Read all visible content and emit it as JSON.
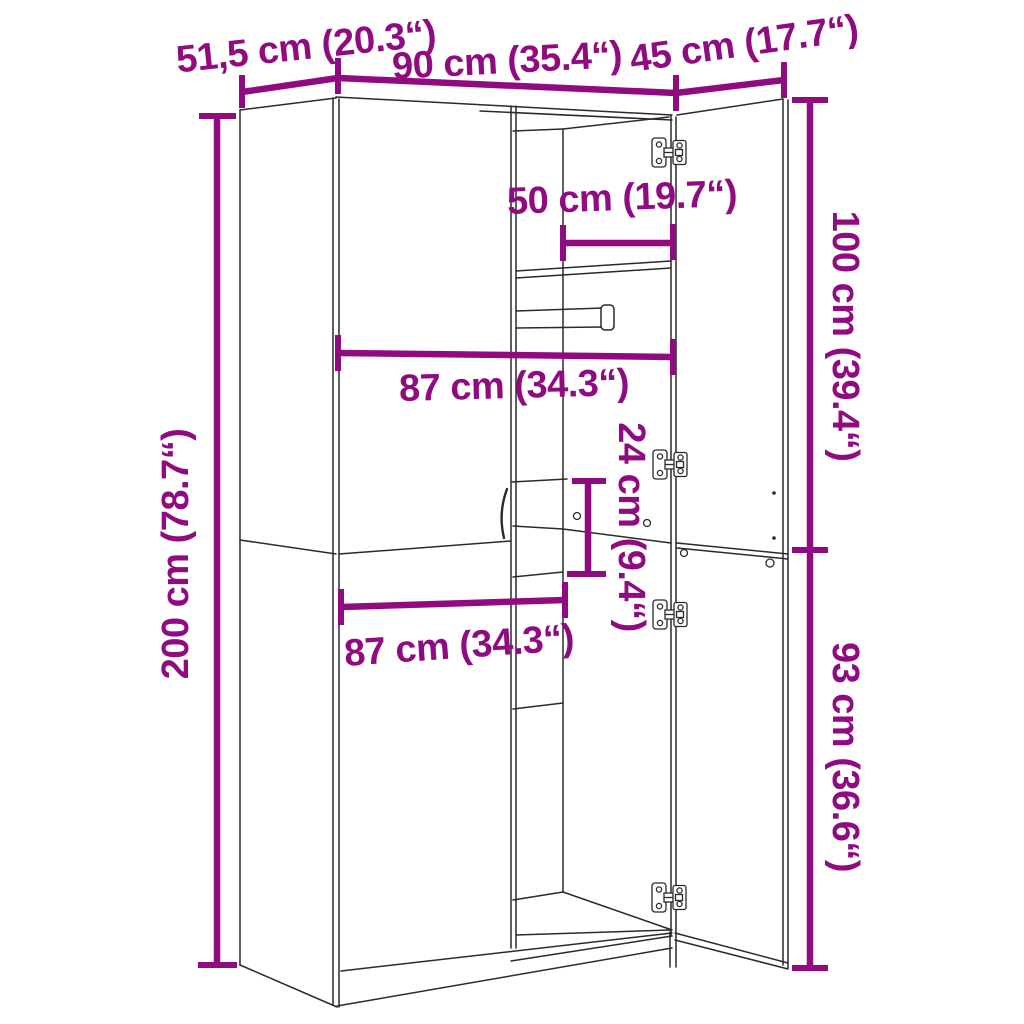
{
  "meta": {
    "title": "Wardrobe dimension diagram",
    "background": "#ffffff"
  },
  "colors": {
    "dimension": "#910b80",
    "line": "#2a2a2a",
    "fill": "#ffffff"
  },
  "dimensions": [
    {
      "id": "top-depth",
      "label": "51,5 cm (20.3“)",
      "value_cm": 51.5,
      "value_in": 20.3,
      "lines": [
        [
          242,
          92,
          338,
          78
        ]
      ],
      "ticks": [
        [
          242,
          75,
          242,
          108
        ],
        [
          338,
          58,
          338,
          94
        ]
      ],
      "label_pos": {
        "x": 306,
        "y": 47,
        "rot": -6
      }
    },
    {
      "id": "top-width",
      "label": "90 cm (35.4“)",
      "value_cm": 90,
      "value_in": 35.4,
      "lines": [
        [
          338,
          78,
          676,
          93
        ]
      ],
      "ticks": [
        [
          676,
          75,
          676,
          111
        ]
      ],
      "label_pos": {
        "x": 507,
        "y": 61,
        "rot": -3
      }
    },
    {
      "id": "door-width",
      "label": "45 cm (17.7“)",
      "value_cm": 45,
      "value_in": 17.7,
      "lines": [
        [
          676,
          93,
          784,
          80
        ]
      ],
      "ticks": [
        [
          784,
          62,
          784,
          98
        ]
      ],
      "label_pos": {
        "x": 744,
        "y": 44,
        "rot": -8
      }
    },
    {
      "id": "inner-depth",
      "label": "50 cm (19.7“)",
      "value_cm": 50,
      "value_in": 19.7,
      "lines": [
        [
          563,
          243,
          673,
          243
        ]
      ],
      "ticks": [
        [
          563,
          225,
          563,
          261
        ],
        [
          673,
          224,
          673,
          260
        ]
      ],
      "label_pos": {
        "x": 622,
        "y": 198,
        "rot": -2
      }
    },
    {
      "id": "upper-inner-width",
      "label": "87 cm (34.3“)",
      "value_cm": 87,
      "value_in": 34.3,
      "lines": [
        [
          338,
          353,
          673,
          357
        ]
      ],
      "ticks": [
        [
          338,
          335,
          338,
          371
        ],
        [
          673,
          339,
          673,
          375
        ]
      ],
      "label_pos": {
        "x": 514,
        "y": 386,
        "rot": -1.5
      }
    },
    {
      "id": "cubby-height",
      "label": "24 cm (9.4“)",
      "value_cm": 24,
      "value_in": 9.4,
      "lines": [
        [
          588,
          481,
          588,
          574
        ]
      ],
      "ticks": [
        [
          572,
          481,
          606,
          481
        ],
        [
          567,
          574,
          606,
          574
        ]
      ],
      "label_pos": {
        "x": 631,
        "y": 527,
        "rot": 90
      }
    },
    {
      "id": "total-height",
      "label": "200 cm (78.7“)",
      "value_cm": 200,
      "value_in": 78.7,
      "lines": [
        [
          217,
          116,
          217,
          965
        ]
      ],
      "ticks": [
        [
          199,
          116,
          236,
          116
        ],
        [
          198,
          965,
          237,
          965
        ]
      ],
      "label_pos": {
        "x": 176,
        "y": 554,
        "rot": -90
      }
    },
    {
      "id": "lower-inner-width",
      "label": "87 cm (34.3“)",
      "value_cm": 87,
      "value_in": 34.3,
      "lines": [
        [
          341,
          607,
          565,
          600
        ]
      ],
      "ticks": [
        [
          341,
          589,
          341,
          625
        ],
        [
          565,
          582,
          565,
          618
        ]
      ],
      "label_pos": {
        "x": 459,
        "y": 646,
        "rot": -4
      }
    },
    {
      "id": "upper-door-height",
      "label": "100 cm (39.4“)",
      "value_cm": 100,
      "value_in": 39.4,
      "lines": [
        [
          810,
          100,
          810,
          550
        ]
      ],
      "ticks": [
        [
          792,
          100,
          828,
          100
        ],
        [
          792,
          550,
          828,
          550
        ]
      ],
      "label_pos": {
        "x": 845,
        "y": 336,
        "rot": 90
      }
    },
    {
      "id": "lower-door-height",
      "label": "93 cm (36.6“)",
      "value_cm": 93,
      "value_in": 36.6,
      "lines": [
        [
          810,
          550,
          810,
          968
        ]
      ],
      "ticks": [
        [
          792,
          968,
          828,
          968
        ]
      ],
      "label_pos": {
        "x": 845,
        "y": 757,
        "rot": 90
      }
    }
  ],
  "structure": {
    "lines": [
      [
        240,
        110,
        240,
        965
      ],
      [
        240,
        110,
        336,
        98
      ],
      [
        240,
        965,
        337,
        1007
      ],
      [
        333,
        98,
        333,
        1004
      ],
      [
        339,
        99,
        339,
        1007
      ],
      [
        336,
        97,
        672,
        115
      ],
      [
        480,
        111,
        672,
        120
      ],
      [
        671,
        115,
        671,
        936
      ],
      [
        676,
        117,
        676,
        967
      ],
      [
        513,
        131,
        563,
        129
      ],
      [
        563,
        129,
        669,
        117
      ],
      [
        563,
        129,
        563,
        892
      ],
      [
        511,
        106,
        511,
        948
      ],
      [
        516,
        106,
        516,
        948
      ],
      [
        516,
        271,
        671,
        261
      ],
      [
        516,
        278,
        671,
        268
      ],
      [
        516,
        311,
        603,
        308
      ],
      [
        516,
        328,
        603,
        327
      ],
      [
        512,
        482,
        567,
        479
      ],
      [
        513,
        526,
        563,
        529
      ],
      [
        563,
        529,
        671,
        543
      ],
      [
        513,
        577,
        563,
        572
      ],
      [
        513,
        709,
        563,
        703
      ],
      [
        513,
        900,
        563,
        892
      ],
      [
        563,
        892,
        672,
        930
      ],
      [
        516,
        935,
        670,
        930
      ],
      [
        339,
        554,
        511,
        541
      ],
      [
        240,
        540,
        336,
        554
      ],
      [
        341,
        971,
        672,
        933
      ],
      [
        511,
        961,
        672,
        936
      ],
      [
        337,
        1006,
        672,
        948
      ],
      [
        670,
        932,
        670,
        967
      ],
      [
        677,
        115,
        783,
        99
      ],
      [
        783,
        99,
        783,
        965
      ],
      [
        788,
        100,
        788,
        968
      ],
      [
        677,
        543,
        788,
        554
      ],
      [
        677,
        548,
        788,
        559
      ],
      [
        675,
        933,
        788,
        963
      ],
      [
        675,
        940,
        788,
        969
      ]
    ],
    "rings": [
      [
        577,
        516,
        3.5
      ],
      [
        647,
        523,
        3.5
      ],
      [
        684,
        553,
        3.5
      ],
      [
        770,
        563,
        4
      ]
    ],
    "dots": [
      [
        774,
        493,
        1.8
      ],
      [
        774,
        538,
        1.8
      ]
    ],
    "handle_path": "M 507 489 Q 498 513 504 538",
    "rod_cap": {
      "x": 601,
      "y": 305,
      "w": 13,
      "h": 25,
      "rx": 4
    },
    "hinges": [
      [
        652,
        137
      ],
      [
        653,
        449
      ],
      [
        653,
        599
      ],
      [
        652,
        882
      ]
    ],
    "hinge_size": {
      "w": 34,
      "h": 31
    }
  }
}
